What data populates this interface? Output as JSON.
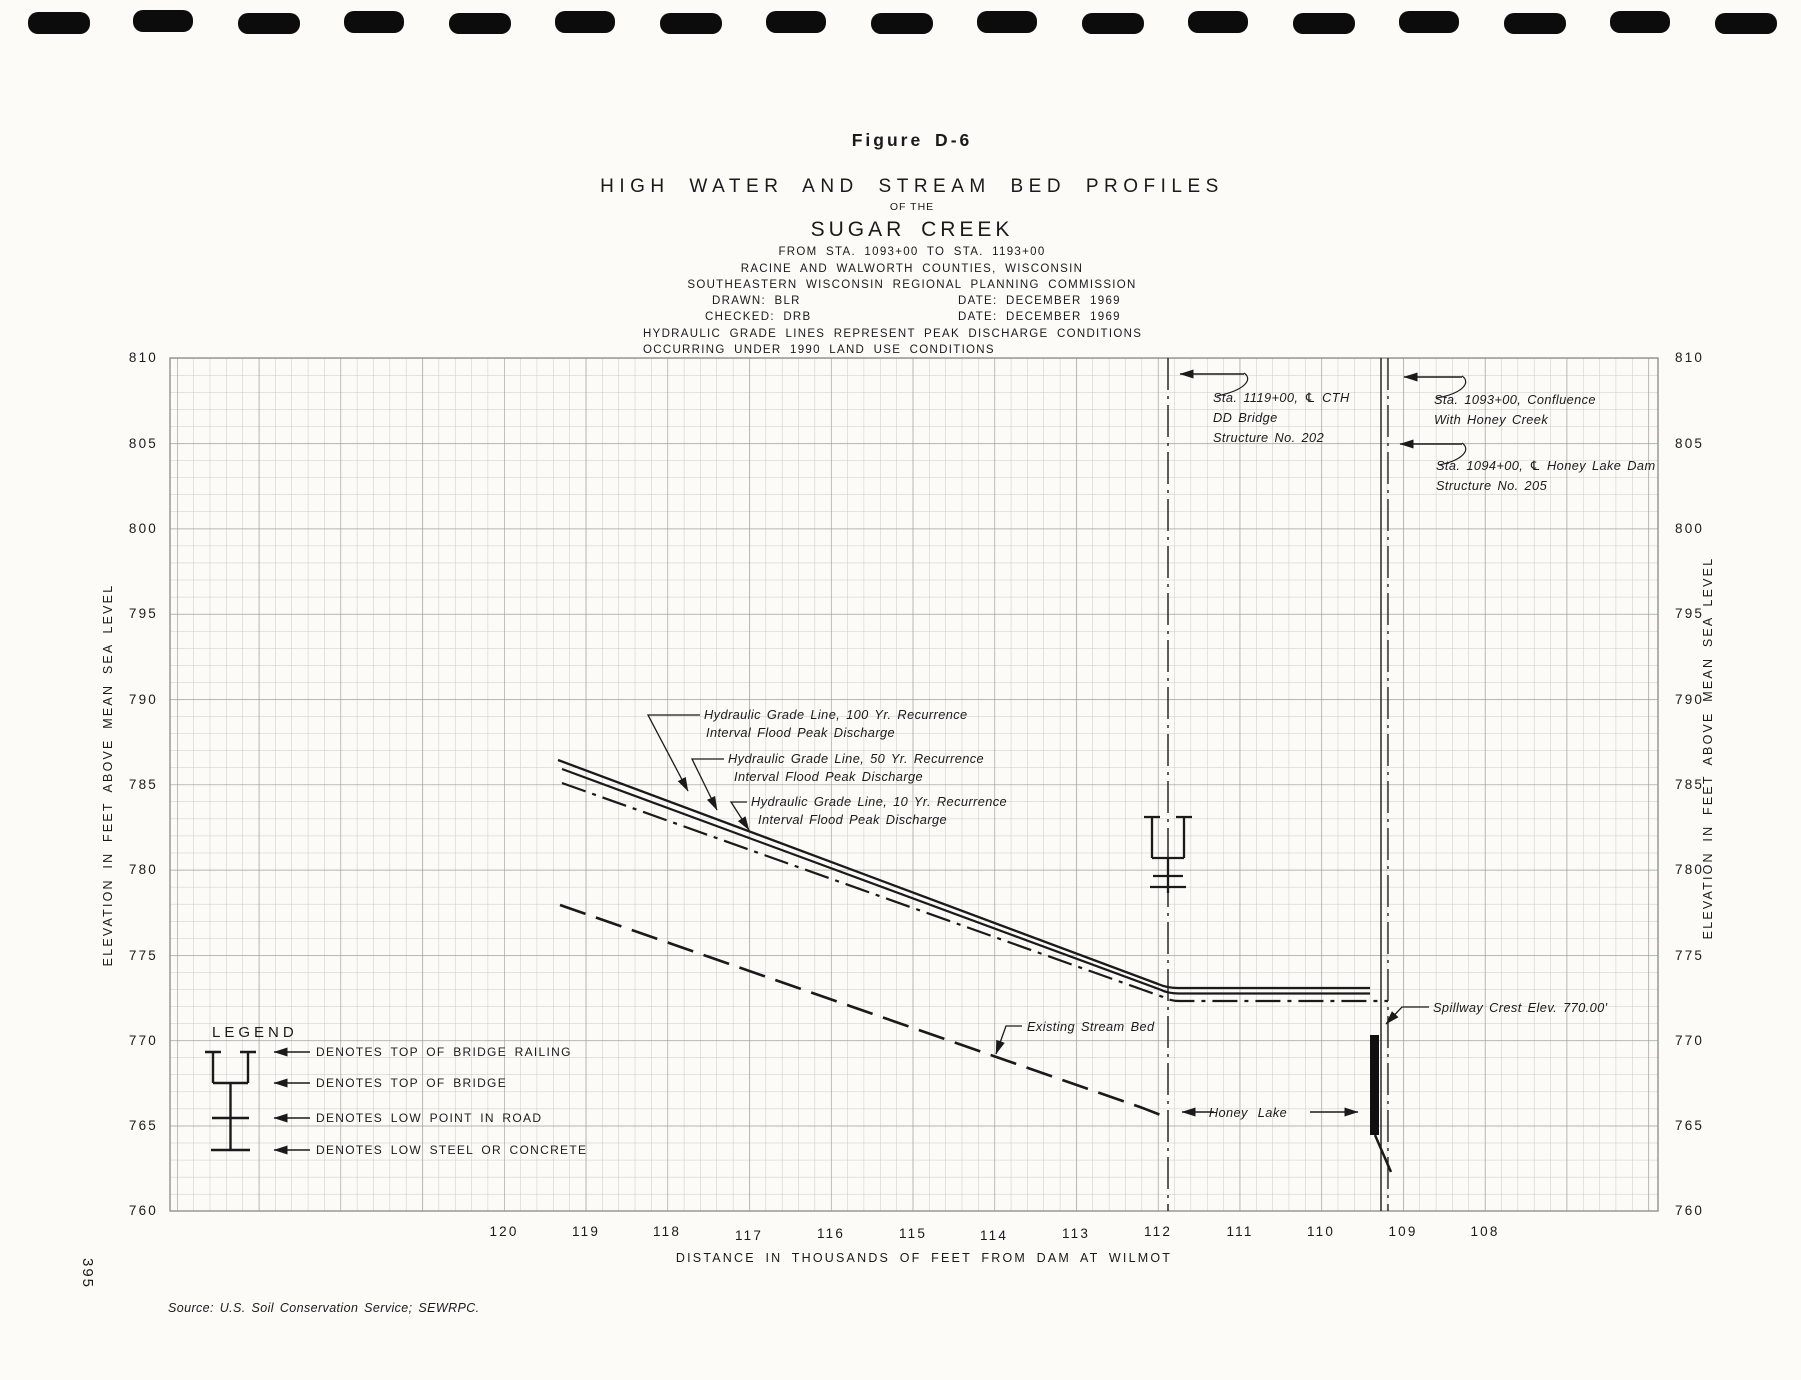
{
  "page": {
    "number": "395",
    "source": "Source: U.S. Soil Conservation Service; SEWRPC."
  },
  "title_block": {
    "figure": "Figure D-6",
    "title": "HIGH WATER AND STREAM BED PROFILES",
    "of_the": "OF THE",
    "subject": "SUGAR CREEK",
    "station_range": "FROM STA. 1093+00 TO STA. 1193+00",
    "counties": "RACINE AND WALWORTH COUNTIES, WISCONSIN",
    "commission": "SOUTHEASTERN WISCONSIN REGIONAL PLANNING COMMISSION",
    "drawn": "DRAWN: BLR",
    "drawn_date": "DATE: DECEMBER 1969",
    "checked": "CHECKED: DRB",
    "checked_date": "DATE: DECEMBER 1969",
    "note1": "HYDRAULIC GRADE LINES REPRESENT PEAK DISCHARGE CONDITIONS",
    "note2": "OCCURRING UNDER 1990 LAND USE CONDITIONS"
  },
  "axes": {
    "x": {
      "title": "DISTANCE IN THOUSANDS OF FEET FROM DAM AT WILMOT",
      "ticks": [
        "120",
        "119",
        "118",
        "117",
        "116",
        "115",
        "114",
        "113",
        "112",
        "111",
        "110",
        "109",
        "108"
      ]
    },
    "y": {
      "title": "ELEVATION IN FEET ABOVE MEAN SEA LEVEL",
      "ticks": [
        "810",
        "805",
        "800",
        "795",
        "790",
        "785",
        "780",
        "775",
        "770",
        "765",
        "760"
      ]
    }
  },
  "legend": {
    "title": "LEGEND",
    "items": [
      "DENOTES TOP OF BRIDGE RAILING",
      "DENOTES TOP OF BRIDGE",
      "DENOTES LOW POINT IN ROAD",
      "DENOTES LOW STEEL OR CONCRETE"
    ]
  },
  "annotations": {
    "sta_bridge_l1": "Sta. 1119+00, ℄ CTH",
    "sta_bridge_l2": "DD Bridge",
    "sta_bridge_l3": "Structure No. 202",
    "sta_confluence_l1": "Sta. 1093+00, Confluence",
    "sta_confluence_l2": "With Honey Creek",
    "sta_dam_l1": "Sta. 1094+00, ℄ Honey Lake Dam",
    "sta_dam_l2": "Structure No. 205",
    "hgl100_l1": "Hydraulic Grade Line, 100 Yr. Recurrence",
    "hgl100_l2": "Interval Flood Peak Discharge",
    "hgl50_l1": "Hydraulic Grade Line, 50 Yr. Recurrence",
    "hgl50_l2": "Interval Flood Peak Discharge",
    "hgl10_l1": "Hydraulic Grade Line, 10 Yr. Recurrence",
    "hgl10_l2": "Interval Flood Peak Discharge",
    "stream_bed": "Existing Stream Bed",
    "honey_lake": "Honey Lake",
    "spillway": "Spillway Crest Elev. 770.00'"
  },
  "colors": {
    "paper": "#fcfbf7",
    "ink": "#1a1a1a",
    "grid_minor": "#c7cac4",
    "grid_major": "#979c95"
  },
  "chart_data": {
    "type": "line",
    "title": "HIGH WATER AND STREAM BED PROFILES OF THE SUGAR CREEK",
    "xlabel": "DISTANCE IN THOUSANDS OF FEET FROM DAM AT WILMOT",
    "ylabel": "ELEVATION IN FEET ABOVE MEAN SEA LEVEL",
    "xlim": [
      124.1,
      105.8
    ],
    "ylim": [
      760,
      810
    ],
    "x_ticks": [
      120,
      119,
      118,
      117,
      116,
      115,
      114,
      113,
      112,
      111,
      110,
      109,
      108
    ],
    "y_ticks": [
      810,
      805,
      800,
      795,
      790,
      785,
      780,
      775,
      770,
      765,
      760
    ],
    "grid": true,
    "series": [
      {
        "name": "Hydraulic Grade Line, 100 Yr. Recurrence Interval Flood Peak Discharge",
        "style": "solid",
        "points": [
          [
            119.3,
            786.5
          ],
          [
            111.9,
            773.0
          ],
          [
            109.4,
            773.0
          ]
        ]
      },
      {
        "name": "Hydraulic Grade Line, 50 Yr. Recurrence Interval Flood Peak Discharge",
        "style": "solid",
        "points": [
          [
            119.3,
            786.0
          ],
          [
            111.9,
            772.7
          ],
          [
            109.4,
            772.7
          ]
        ]
      },
      {
        "name": "Hydraulic Grade Line, 10 Yr. Recurrence Interval Flood Peak Discharge",
        "style": "dash-dot",
        "points": [
          [
            119.3,
            785.2
          ],
          [
            111.9,
            772.3
          ],
          [
            109.3,
            772.3
          ]
        ]
      },
      {
        "name": "Existing Stream Bed",
        "style": "dashed",
        "points": [
          [
            119.3,
            777.5
          ],
          [
            111.9,
            765.5
          ]
        ]
      }
    ],
    "features": {
      "cth_dd_bridge": {
        "station": "1119+00",
        "distance_kft": 111.9,
        "structure_no": "202",
        "top_of_railing_ft": 783.2,
        "top_of_bridge_ft": 780.6,
        "low_point_in_road_ft": 779.6,
        "low_steel_or_concrete_ft": 779.1
      },
      "honey_lake_dam": {
        "station": "1094+00",
        "distance_kft": 109.4,
        "structure_no": "205",
        "spillway_crest_ft": 770.0
      },
      "confluence_with_honey_creek": {
        "station": "1093+00",
        "distance_kft": 109.3
      },
      "honey_lake_surface_elev_ft": 765.8
    }
  }
}
